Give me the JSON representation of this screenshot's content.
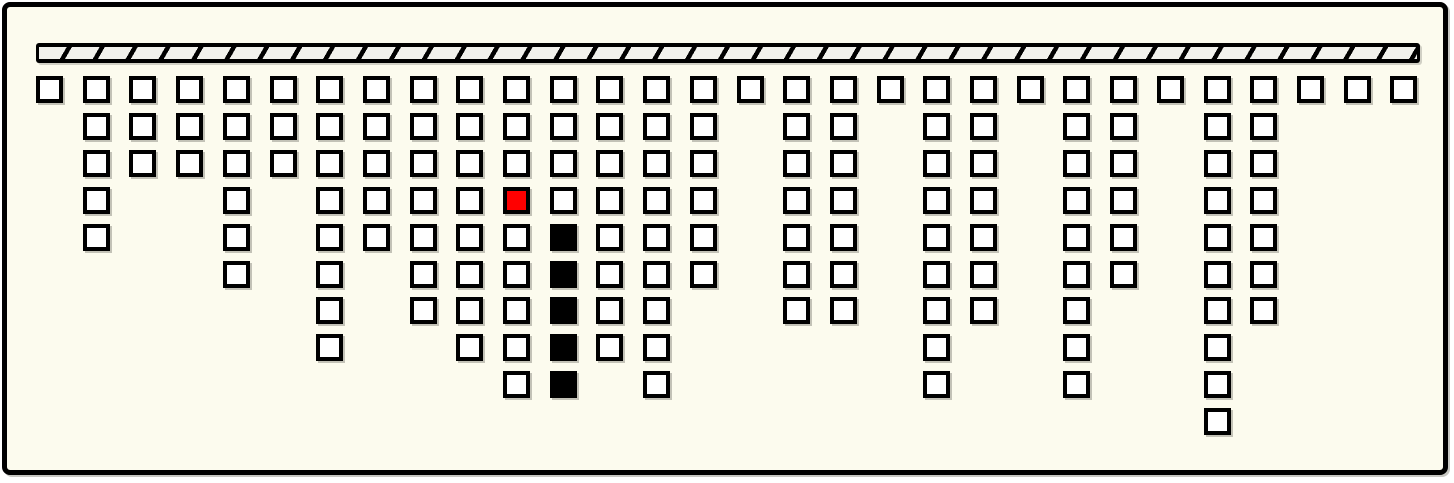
{
  "frame": {
    "background_color": "#FCFBEE",
    "border_color": "#000000",
    "page_background": "#FFFFFF"
  },
  "ceiling_bar": {
    "fill_color": "#000000",
    "hatch_fill_color": "#F1F1EC"
  },
  "grid": {
    "num_columns": 30,
    "column_heights": [
      1,
      5,
      3,
      3,
      6,
      3,
      8,
      5,
      7,
      8,
      9,
      9,
      8,
      9,
      6,
      1,
      7,
      7,
      1,
      9,
      7,
      1,
      9,
      6,
      1,
      10,
      7,
      1,
      1,
      1
    ],
    "square_fill_color": "#FFFFFF",
    "square_border_color": "#000000",
    "highlight_squares": [
      {
        "column": 11,
        "row": 4,
        "color": "#FF0000",
        "name": "red-square"
      },
      {
        "column": 12,
        "row": 5,
        "color": "#000000",
        "name": "black-square"
      },
      {
        "column": 12,
        "row": 6,
        "color": "#000000",
        "name": "black-square"
      },
      {
        "column": 12,
        "row": 7,
        "color": "#000000",
        "name": "black-square"
      },
      {
        "column": 12,
        "row": 8,
        "color": "#000000",
        "name": "black-square"
      },
      {
        "column": 12,
        "row": 9,
        "color": "#000000",
        "name": "black-square"
      }
    ]
  }
}
